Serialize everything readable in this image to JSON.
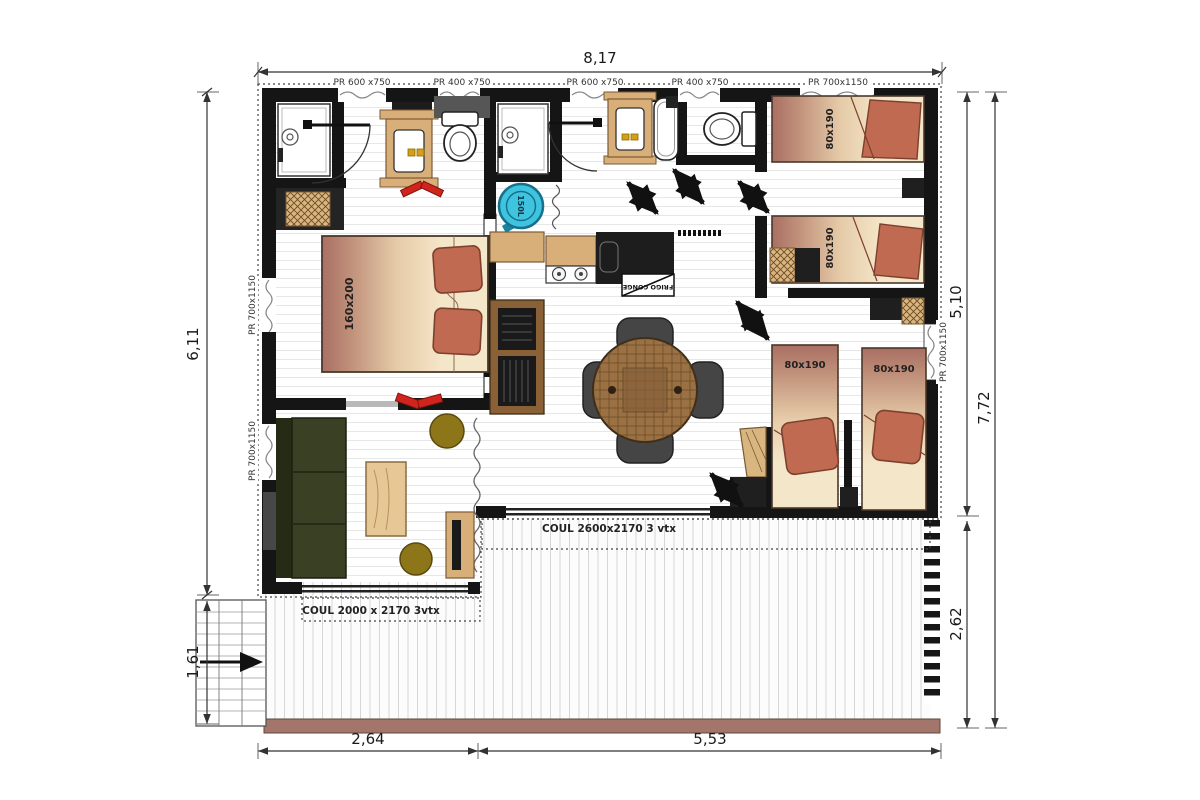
{
  "floorplan": {
    "dimensions": {
      "width_total": "8,17",
      "height_left": "6,11",
      "height_right_main": "5,10",
      "height_right_total": "7,72",
      "terrace_height": "2,62",
      "bottom_left_width": "2,64",
      "bottom_right_width": "5,53",
      "ramp_height": "1,61"
    },
    "window_labels": {
      "top": [
        "PR 600 x750",
        "PR 400 x750",
        "PR 600 x750",
        "PR 400 x750",
        "PR 700x1150"
      ],
      "left": [
        "PR 700x1150",
        "PR 700x1150"
      ],
      "right": [
        "PR 700x1150"
      ]
    },
    "sliding_door_labels": {
      "terrace_main": "COUL 2600x2170 3 vtx",
      "terrace_living": "COUL 2000 x 2170 3vtx"
    },
    "furniture_labels": {
      "master_bed": "160x200",
      "single_bed_1": "80x190",
      "single_bed_2": "80x190",
      "single_bed_3": "80x190",
      "single_bed_4": "80x190",
      "water_heater": "150L",
      "fridge_freezer": "FRIGO CONGE"
    },
    "colors": {
      "wall": "#151515",
      "water_heater": "#3fc4e0",
      "pillow": "#c06a52",
      "bed_gradient_dark": "#a96f63",
      "bed_gradient_light": "#f4e6c8",
      "sofa": "#3a4024",
      "pouf": "#8d7519",
      "wood": "#d9af79",
      "dining_table": "#9b7143",
      "terrace_edge": "#a3756b",
      "slippers": "#d0251c"
    }
  }
}
